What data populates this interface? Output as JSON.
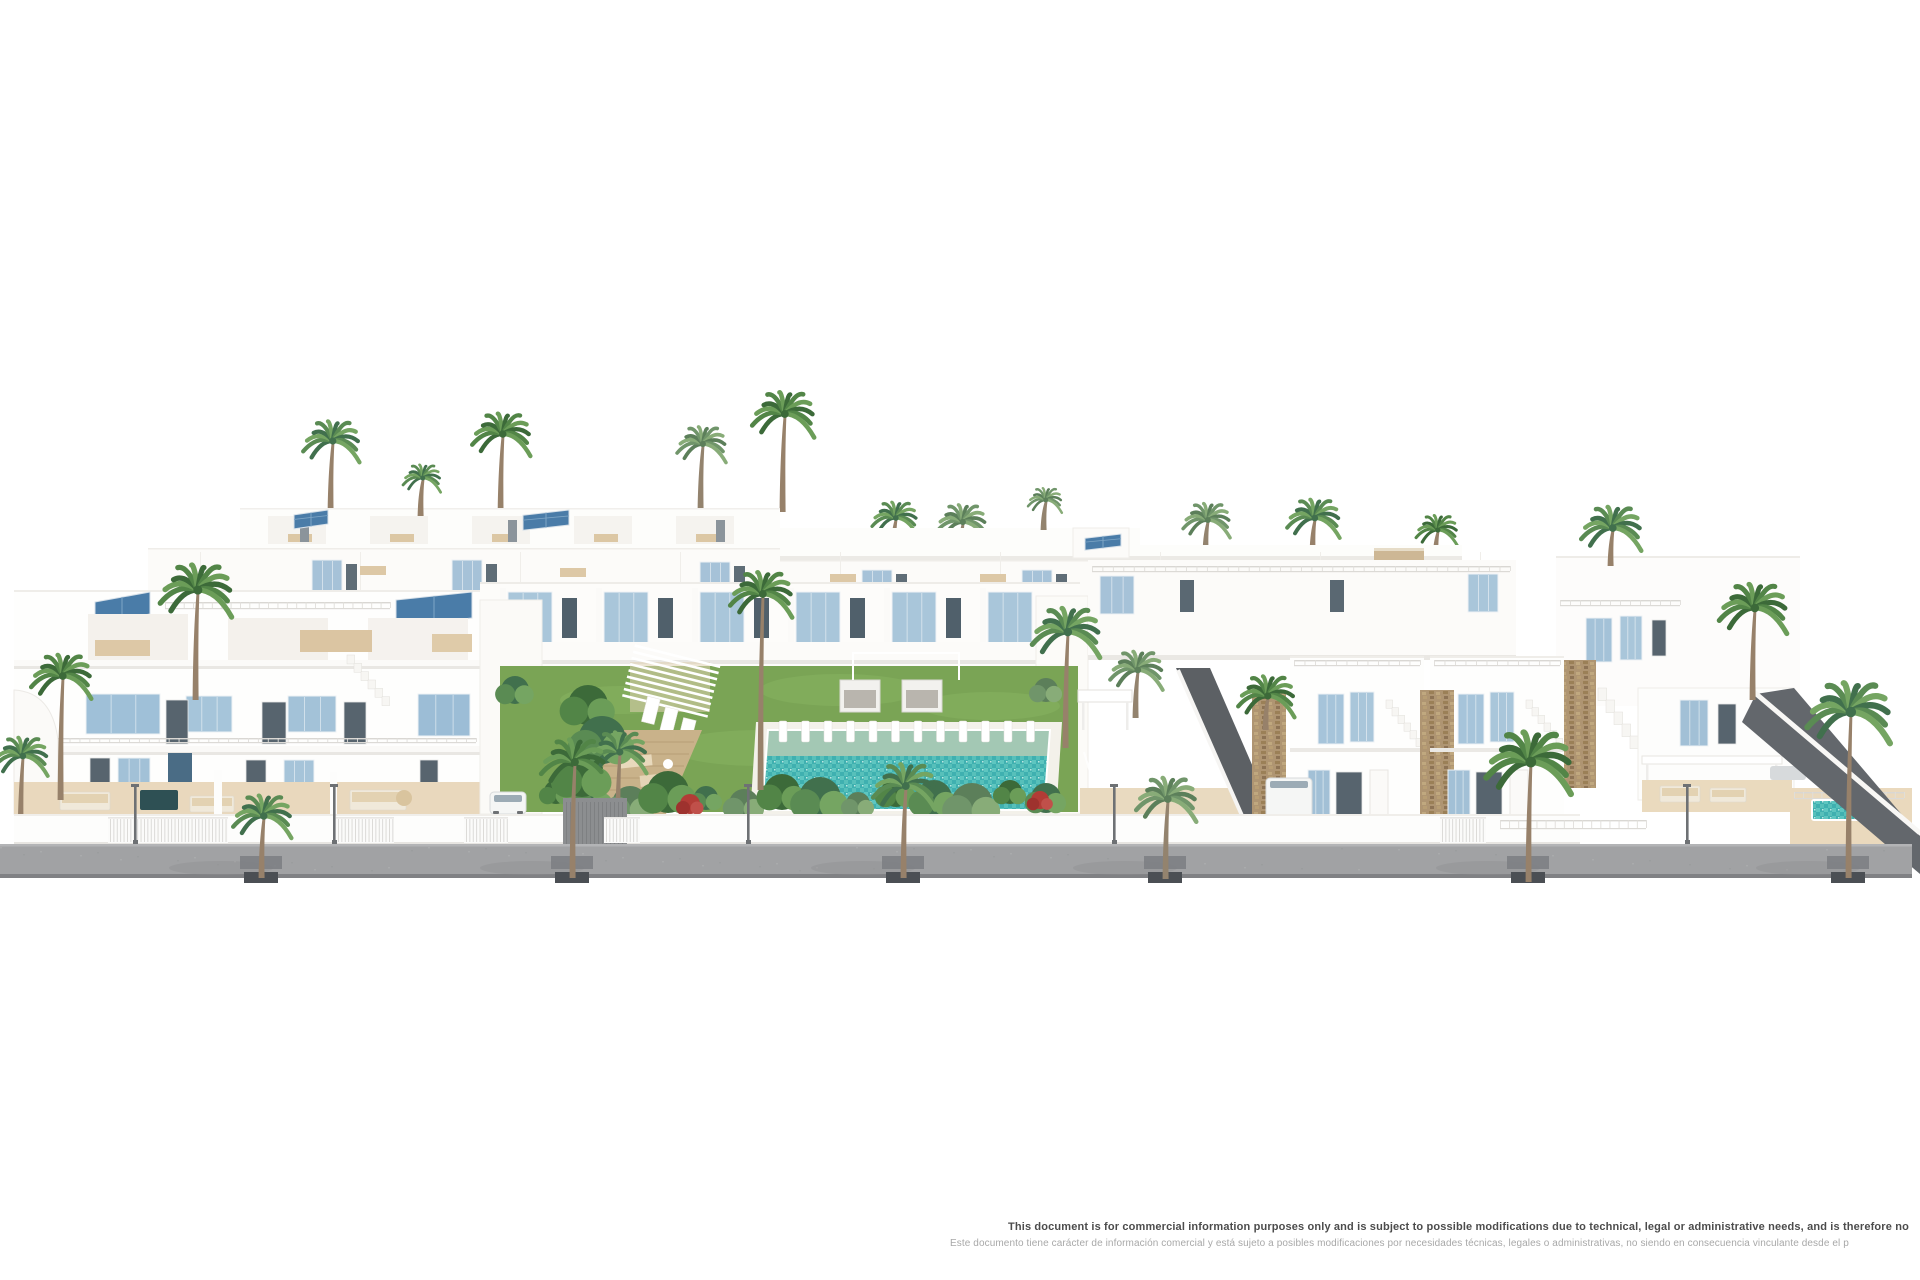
{
  "disclaimer": {
    "line_en": "This document is for commercial information purposes only and is subject to possible modifications due to technical, legal or administrative needs, and is therefore no",
    "line_es": "Este documento tiene carácter de información comercial y está sujeto a posibles modificaciones por necesidades técnicas, legales o administrativas, no siendo en consecuencia vinculante desde el p"
  },
  "palette": {
    "background": "#ffffff",
    "building_white": "#fdfcfa",
    "shadow_tone": "#e9e7e3",
    "shutter_blue": "#a6c2d8",
    "glass_dark": "#57646e",
    "solar_panel_blue": "#4a7ca8",
    "pool_turquoise": "#45b4b2",
    "pool_shelf": "#a3c8b4",
    "lawn_green": "#7aa455",
    "palm_green": "#528547",
    "terrace_beige": "#ecdcc2",
    "stone_tan": "#af9572",
    "sidewalk_gray": "#a1a2a4",
    "curb_dark": "#4b4f54",
    "text_dark": "#4c4c4c",
    "text_light": "#a8a8a8"
  }
}
